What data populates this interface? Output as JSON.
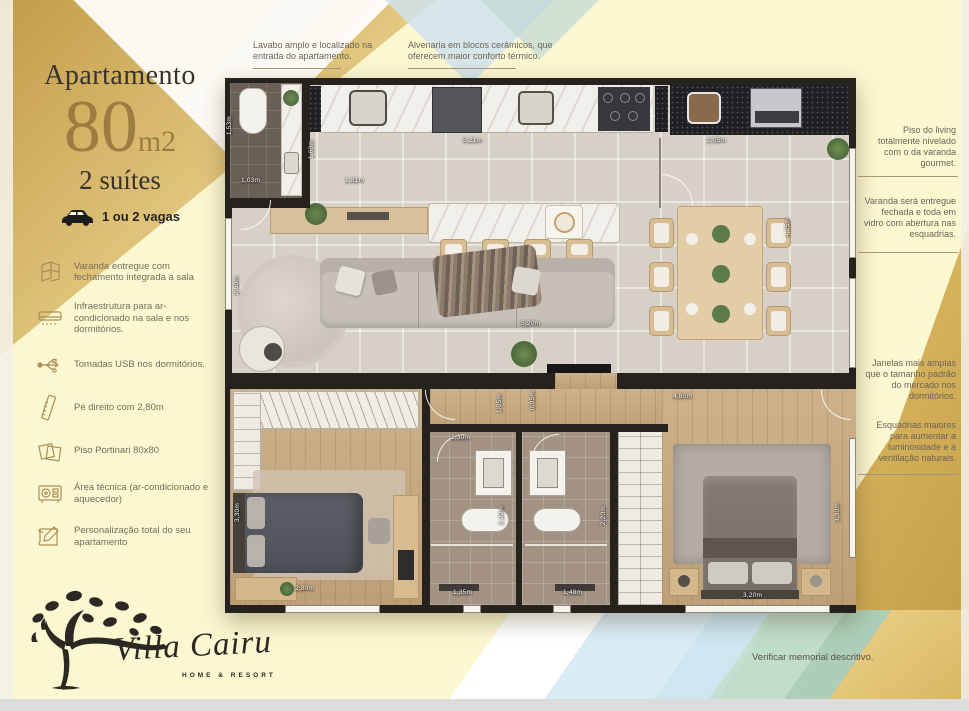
{
  "colors": {
    "accent_gold": "#9d7c41",
    "background": "#fbf7d0",
    "wall": "#26231f",
    "annotation_text": "#6d6458"
  },
  "sidebar": {
    "title": "Apartamento",
    "area_value": "80",
    "area_unit": "m2",
    "suites": "2 suítes",
    "parking_label": "1 ou 2 vagas",
    "features": [
      {
        "icon": "varanda-icon",
        "text": "Varanda entregue com fechamento integrada a sala"
      },
      {
        "icon": "ac-unit-icon",
        "text": "Infraestrutura para ar-condicionado na sala e nos dormitórios."
      },
      {
        "icon": "usb-icon",
        "text": "Tomadas USB nos dormitórios."
      },
      {
        "icon": "ruler-icon",
        "text": "Pé direito com 2,80m"
      },
      {
        "icon": "floor-tile-icon",
        "text": "Piso Portinari 80x80"
      },
      {
        "icon": "tech-area-icon",
        "text": "Área técnica (ar-condicionado e aquecedor)"
      },
      {
        "icon": "blueprint-icon",
        "text": "Personalização total do seu apartamento"
      }
    ]
  },
  "annotations": {
    "top_left": "Lavabo amplo e localizado na entrada do apartamento.",
    "top_right": "Alvenaria em blocos cerâmicos, que oferecem maior conforto térmico.",
    "right_1": "Piso do living totalmente nivelado com o da varanda gourmet.",
    "right_2": "Varanda será entregue fechada e toda em vidro com abertura nas esquadrias.",
    "right_3": "Janelas mais amplas que o tamanho padrão do mercado nos dormitórios.",
    "right_4": "Esquadrias maiores para aumentar a luminosidade e a ventilação naturais."
  },
  "floorplan": {
    "dimensions": [
      {
        "label": "1,53m"
      },
      {
        "label": "1,03m"
      },
      {
        "label": "1,60m"
      },
      {
        "label": "1,81m"
      },
      {
        "label": "5,21m"
      },
      {
        "label": "2,05m"
      },
      {
        "label": "4,25m"
      },
      {
        "label": "2,60m"
      },
      {
        "label": "5,20m"
      },
      {
        "label": "1,05m"
      },
      {
        "label": "0,95m"
      },
      {
        "label": "4,80m"
      },
      {
        "label": "1,30m"
      },
      {
        "label": "3,30m"
      },
      {
        "label": "2,20m"
      },
      {
        "label": "2,20m"
      },
      {
        "label": "3,30m"
      },
      {
        "label": "2,80m"
      },
      {
        "label": "1,35m"
      },
      {
        "label": "1,48m"
      },
      {
        "label": "3,20m"
      }
    ]
  },
  "logo": {
    "brand": "Villa Cairu",
    "tagline": "HOME & RESORT"
  },
  "footer": {
    "disclaimer": "Verificar memorial descritivo."
  }
}
